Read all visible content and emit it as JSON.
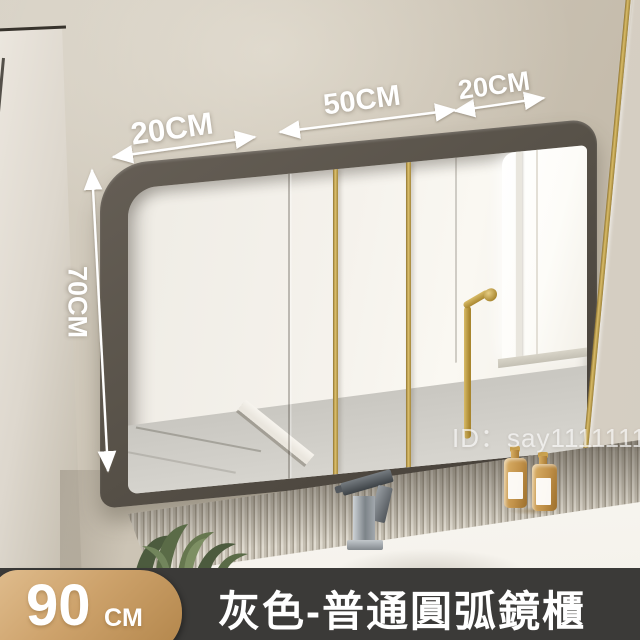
{
  "annotations": {
    "width_left": "20CM",
    "width_middle": "50CM",
    "width_right": "20CM",
    "height": "70CM"
  },
  "watermark": "ID：say11111111",
  "banner": {
    "size_number": "90",
    "size_unit": "CM",
    "title": "灰色-普通圓弧鏡櫃"
  },
  "colors": {
    "wall": "#cdc5b6",
    "cabinet_frame": "#585249",
    "gold_trim": "#c3a052",
    "mirror_reflection": "#f5f2ec",
    "fluted_panel": "#d8d2c6",
    "countertop": "#f6f4ef",
    "banner_background": "#3b3a38",
    "badge_gold_light": "#e0bd8e",
    "badge_gold_dark": "#b2854a",
    "plant_green": "#5a6b47",
    "bottle_amber": "#c2924a",
    "annotation_text": "#ffffff"
  }
}
